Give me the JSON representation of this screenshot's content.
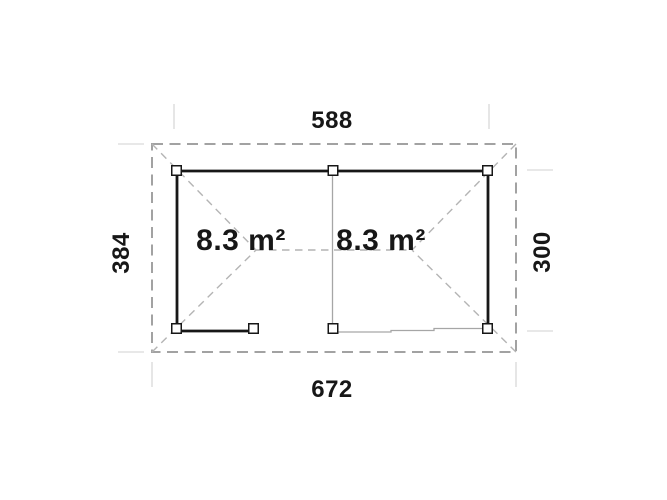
{
  "diagram": {
    "dimensions": {
      "top": "588",
      "bottom": "672",
      "left": "384",
      "right": "300"
    },
    "rooms": [
      {
        "area_label": "8.3 m²"
      },
      {
        "area_label": "8.3 m²"
      }
    ],
    "colors": {
      "background": "#ffffff",
      "wall": "#171717",
      "thin_wall": "#a6a6a6",
      "roof_outline": "#a2a2a2",
      "hip_line": "#b4b4b4",
      "tick": "#e0e0e0",
      "text": "#171717"
    }
  }
}
